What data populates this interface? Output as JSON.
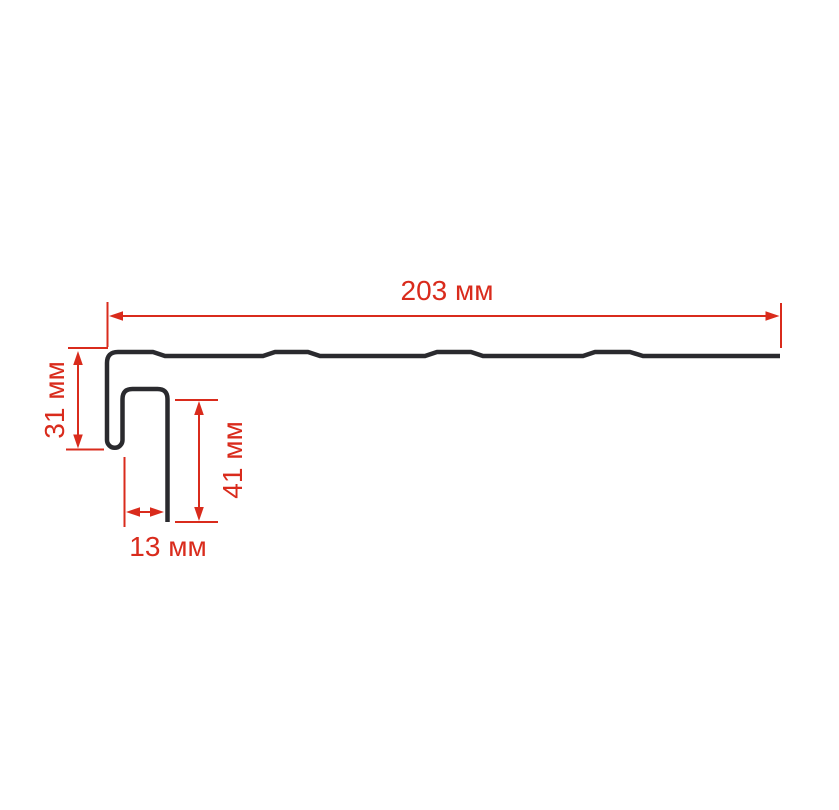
{
  "drawing": {
    "background": "#ffffff",
    "unit": "мм",
    "colors": {
      "profile": "#2a2a2e",
      "dimension": "#d92b1c"
    },
    "dimensions": {
      "length": {
        "value": 203,
        "label": "203 мм"
      },
      "left_height": {
        "value": 31,
        "label": "31 мм"
      },
      "channel_depth": {
        "value": 41,
        "label": "41 мм"
      },
      "channel_width": {
        "value": 13,
        "label": "13 мм"
      }
    }
  }
}
